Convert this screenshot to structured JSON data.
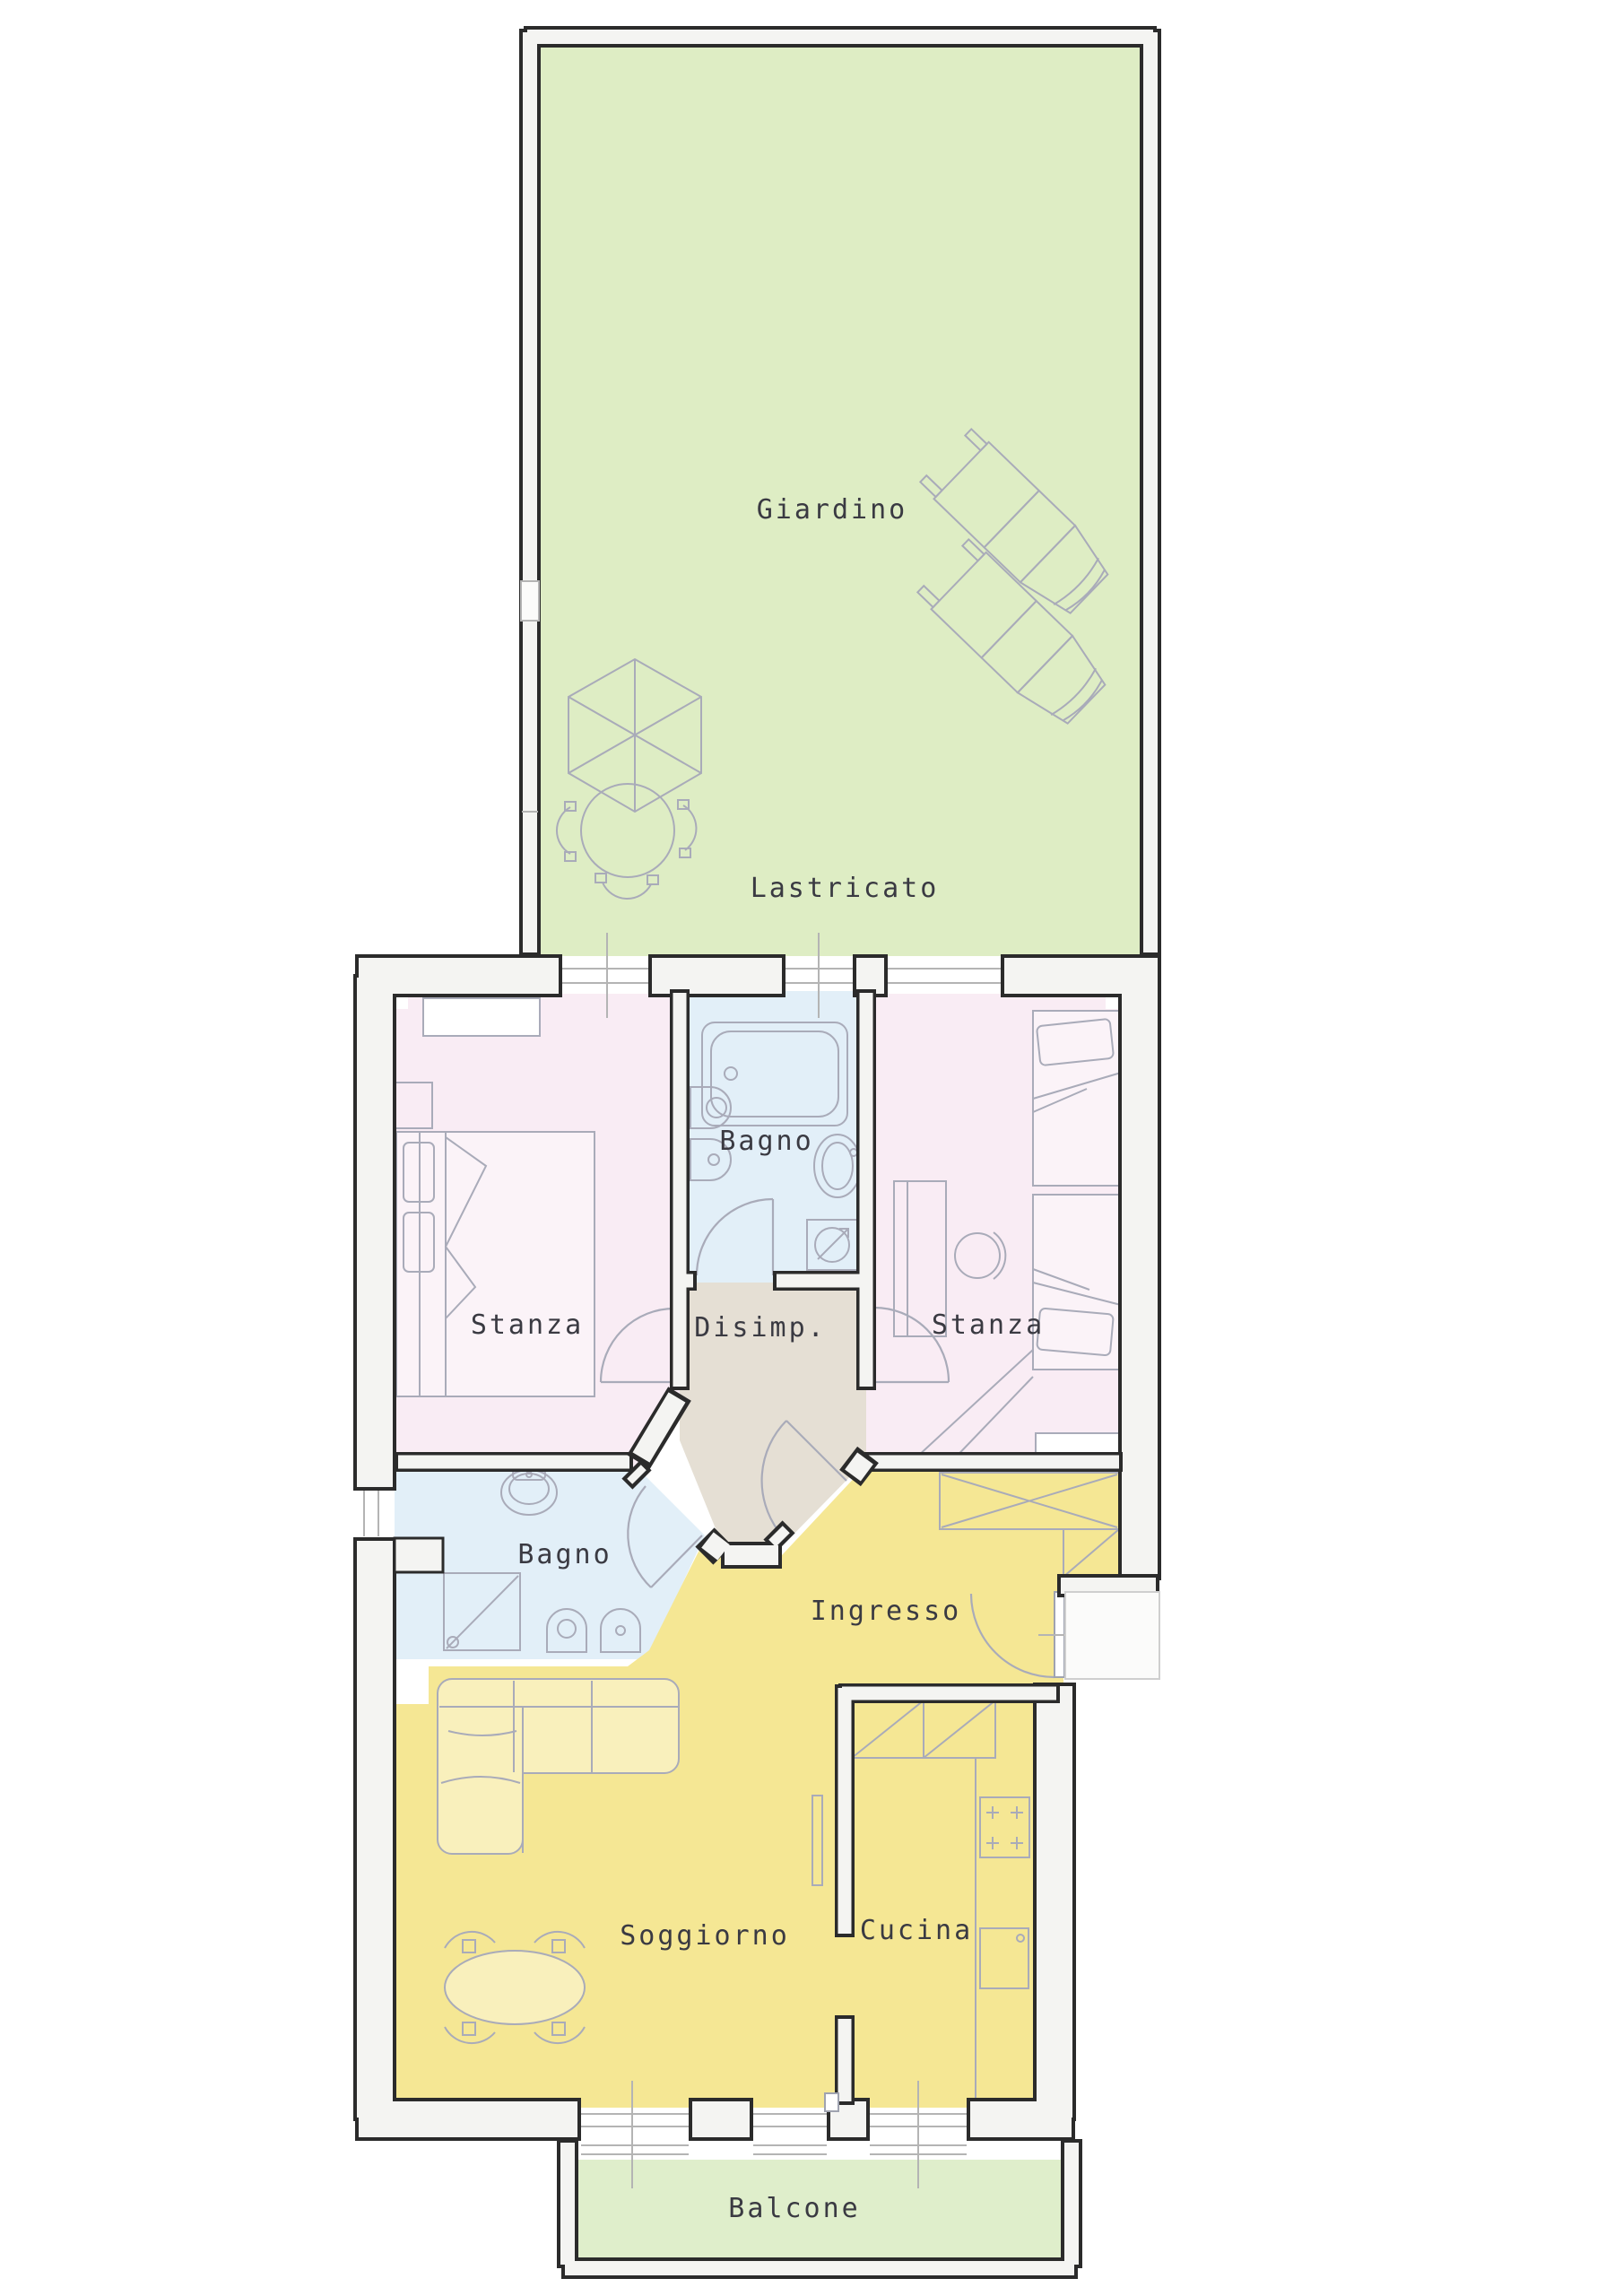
{
  "colors": {
    "garden_green": "#deedc4",
    "balcony_green": "#dfeecb",
    "bedroom_pink": "#f9ecf4",
    "bathroom_blue": "#e2eff8",
    "hallway_beige": "#e5dfd4",
    "living_yellow": "#f5e794",
    "wall_fill": "#f4f4f2",
    "wall_line": "#2b2b2b",
    "furniture_line": "#a9abb9",
    "sill_line": "#b4b4b4",
    "label_color": "#3a3a42"
  },
  "rooms": {
    "giardino": {
      "label": "Giardino"
    },
    "lastricato": {
      "label": "Lastricato"
    },
    "bagno_nord": {
      "label": "Bagno"
    },
    "stanza_ovest": {
      "label": "Stanza"
    },
    "disimpegno": {
      "label": "Disimp."
    },
    "stanza_est": {
      "label": "Stanza"
    },
    "bagno_sud": {
      "label": "Bagno"
    },
    "ingresso": {
      "label": "Ingresso"
    },
    "soggiorno": {
      "label": "Soggiorno"
    },
    "cucina": {
      "label": "Cucina"
    },
    "balcone": {
      "label": "Balcone"
    }
  }
}
